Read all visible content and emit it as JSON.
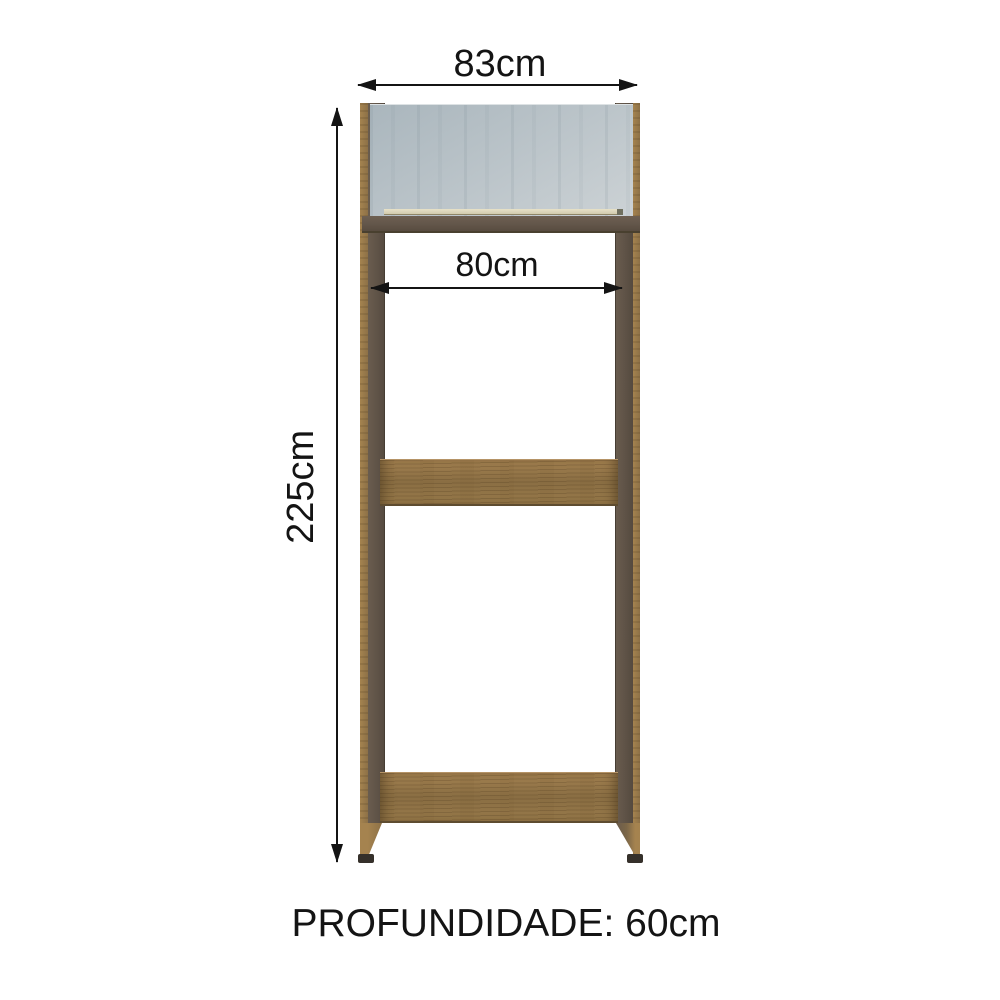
{
  "labels": {
    "outer_width": "83cm",
    "inner_width": "80cm",
    "height": "225cm",
    "depth": "PROFUNDIDADE: 60cm"
  },
  "colors": {
    "background": "#ffffff",
    "ink": "#141414",
    "wood_edge": "#a5834f",
    "wood_edge_dark": "#8d7147",
    "panel_face": "#5f5347",
    "frame_bar": "#63564a",
    "shelf_light": "#a28050",
    "shelf_dark": "#8a6e43",
    "glass_light": "#ccd2d5",
    "glass_dark": "#aab6bd",
    "glass_trim": "#e7e1c8",
    "foot": "#35302a"
  }
}
